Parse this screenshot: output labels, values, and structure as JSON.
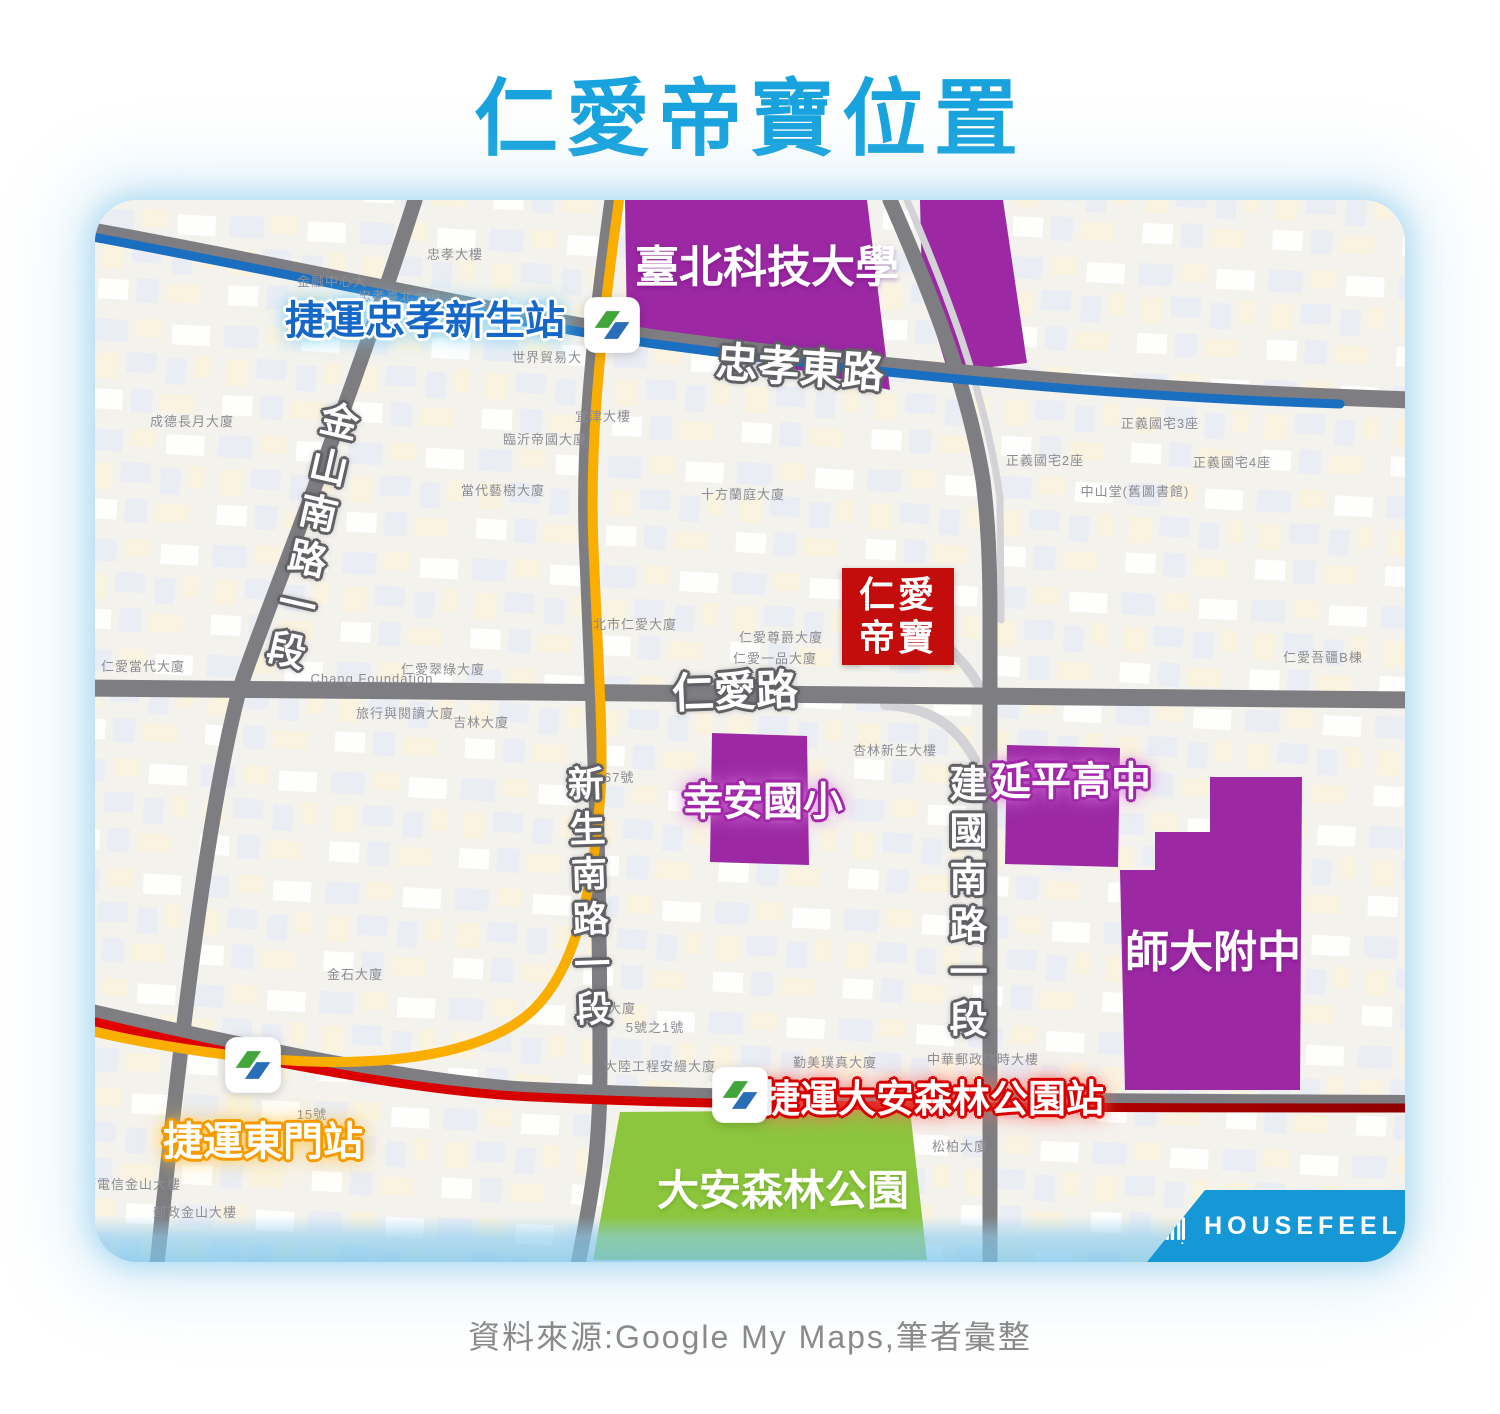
{
  "title": "仁愛帝寶位置",
  "caption": "資料來源:Google My Maps,筆者彙整",
  "watermark": {
    "brand": "HOUSEFEEL"
  },
  "badge": {
    "line1": "仁愛",
    "line2": "帝寶"
  },
  "palette": {
    "title_blue": "#18A3DE",
    "caption_gray": "#8A8A8A",
    "map_bg": "#F4F2ED",
    "road_gray": "#7E7E82",
    "mrt_blue_line": "#1B6FC0",
    "mrt_yellow_line": "#F9AE00",
    "mrt_red_line": "#CE0000",
    "school_purple": "#9C28A4",
    "park_green": "#8CC63E",
    "badge_red": "#C30D0D",
    "station_blue_text": "#1568C8",
    "banner_blue": "#1798D6",
    "metro_logo_green": "#43A63C",
    "metro_logo_blue": "#2A6EB8"
  },
  "map": {
    "road_labels": [
      {
        "id": "zhongxiao-east-road",
        "text": "忠孝東路",
        "x": 705,
        "y": 168,
        "size": 42,
        "rotate": 4,
        "style": "road-label"
      },
      {
        "id": "jinshan-south-road-sec1",
        "text": "金山南路一段",
        "x": 212,
        "y": 338,
        "size": 38,
        "rotate": 13,
        "vertical": true,
        "style": "road-label"
      },
      {
        "id": "renai-road",
        "text": "仁愛路",
        "x": 640,
        "y": 492,
        "size": 42,
        "rotate": -2,
        "style": "road-label"
      },
      {
        "id": "xinsheng-south-road-sec1",
        "text": "新生南路一段",
        "x": 492,
        "y": 700,
        "size": 36,
        "rotate": -2,
        "vertical": true,
        "style": "road-label"
      },
      {
        "id": "jianguo-south-road-sec1",
        "text": "建國南路一段",
        "x": 868,
        "y": 705,
        "size": 38,
        "rotate": 0,
        "vertical": true,
        "style": "road-label"
      }
    ],
    "place_labels": [
      {
        "id": "taipei-tech",
        "text": "臺北科技大學",
        "x": 672,
        "y": 68,
        "size": 44,
        "style": "on-purple"
      },
      {
        "id": "xingan-elementary",
        "text": "幸安國小",
        "x": 668,
        "y": 602,
        "size": 40,
        "style": "glow-purple"
      },
      {
        "id": "yanping-high",
        "text": "延平高中",
        "x": 976,
        "y": 582,
        "size": 40,
        "style": "glow-purple"
      },
      {
        "id": "shida-fuzhong",
        "text": "師大附中",
        "x": 1118,
        "y": 753,
        "size": 44,
        "style": "on-purple"
      },
      {
        "id": "daan-forest-park",
        "text": "大安森林公園",
        "x": 688,
        "y": 991,
        "size": 42,
        "style": "on-green"
      }
    ],
    "station_labels": [
      {
        "id": "mrt-zhongxiao-xinsheng",
        "text": "捷運忠孝新生站",
        "x": 330,
        "y": 121,
        "size": 40,
        "style": "glow-blue-text"
      },
      {
        "id": "mrt-dongmen",
        "text": "捷運東門站",
        "x": 168,
        "y": 942,
        "size": 40,
        "style": "glow-orange"
      },
      {
        "id": "mrt-daan-forest-park",
        "text": "捷運大安森林公園站",
        "x": 838,
        "y": 901,
        "size": 38,
        "style": "glow-red"
      }
    ],
    "stations": [
      {
        "id": "zhongxiao-xinsheng",
        "x": 517,
        "y": 125
      },
      {
        "id": "dongmen",
        "x": 158,
        "y": 865
      },
      {
        "id": "daan-forest-park",
        "x": 645,
        "y": 895
      }
    ],
    "building_labels": [
      {
        "text": "忠孝大樓",
        "x": 360,
        "y": 55
      },
      {
        "text": "金融中心大",
        "x": 237,
        "y": 82
      },
      {
        "text": "忠孝臺北大廈",
        "x": 305,
        "y": 97
      },
      {
        "text": "世界貿易大",
        "x": 452,
        "y": 158
      },
      {
        "text": "宜津大樓",
        "x": 508,
        "y": 217
      },
      {
        "text": "成德長月大廈",
        "x": 97,
        "y": 222
      },
      {
        "text": "臨沂帝國大廈",
        "x": 450,
        "y": 240
      },
      {
        "text": "當代藝樹大廈",
        "x": 408,
        "y": 291
      },
      {
        "text": "十方蘭庭大廈",
        "x": 648,
        "y": 295
      },
      {
        "text": "正義國宅3座",
        "x": 1065,
        "y": 224
      },
      {
        "text": "正義國宅2座",
        "x": 950,
        "y": 261
      },
      {
        "text": "正義國宅4座",
        "x": 1137,
        "y": 263
      },
      {
        "text": "中山堂(舊圖書館)",
        "x": 1040,
        "y": 292
      },
      {
        "text": "仁愛當代大廈",
        "x": 48,
        "y": 467
      },
      {
        "text": "Chang Foundation",
        "x": 277,
        "y": 479
      },
      {
        "text": "仁愛翠綠大廈",
        "x": 348,
        "y": 470
      },
      {
        "text": "北市仁愛大廈",
        "x": 540,
        "y": 425
      },
      {
        "text": "仁愛尊爵大廈",
        "x": 686,
        "y": 438
      },
      {
        "text": "仁愛一品大廈",
        "x": 680,
        "y": 459
      },
      {
        "text": "仁愛吾疆B棟",
        "x": 1228,
        "y": 458
      },
      {
        "text": "旅行與閱讀大廈",
        "x": 310,
        "y": 514
      },
      {
        "text": "吉林大廈",
        "x": 386,
        "y": 523
      },
      {
        "text": "杏林新生大樓",
        "x": 800,
        "y": 551
      },
      {
        "text": "167號",
        "x": 520,
        "y": 578
      },
      {
        "text": "金石大廈",
        "x": 260,
        "y": 775
      },
      {
        "text": "門庭大廈",
        "x": 513,
        "y": 809
      },
      {
        "text": "5號之1號",
        "x": 560,
        "y": 828
      },
      {
        "text": "15號",
        "x": 217,
        "y": 915
      },
      {
        "text": "中華電信金山大樓",
        "x": 30,
        "y": 985
      },
      {
        "text": "郵政金山大樓",
        "x": 100,
        "y": 1013
      },
      {
        "text": "大陸工程安縵大廈",
        "x": 565,
        "y": 867
      },
      {
        "text": "勤美璞真大廈",
        "x": 740,
        "y": 863
      },
      {
        "text": "中華郵政瑞時大樓",
        "x": 888,
        "y": 860
      },
      {
        "text": "松柏大廈",
        "x": 865,
        "y": 947
      }
    ]
  }
}
